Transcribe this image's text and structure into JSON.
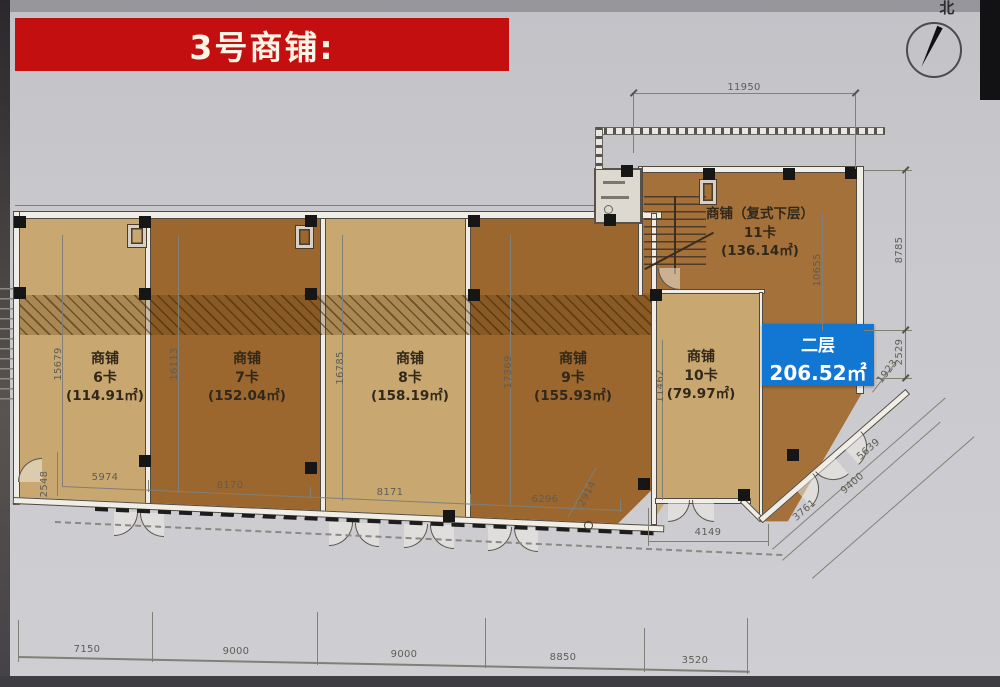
{
  "banner": {
    "title": "3号商铺:"
  },
  "compass": {
    "north_label": "北"
  },
  "floor_badge": {
    "floor": "二层",
    "area": "206.52㎡",
    "bg_color": "#1277d3"
  },
  "shops": [
    {
      "title": "商铺",
      "unit": "6卡",
      "area": "(114.91㎡)",
      "height_dim": "15679",
      "tone": "light"
    },
    {
      "title": "商铺",
      "unit": "7卡",
      "area": "(152.04㎡)",
      "height_dim": "16113",
      "tone": "brown"
    },
    {
      "title": "商铺",
      "unit": "8卡",
      "area": "(158.19㎡)",
      "height_dim": "16785",
      "tone": "light"
    },
    {
      "title": "商铺",
      "unit": "9卡",
      "area": "(155.93㎡)",
      "height_dim": "17369",
      "tone": "brown"
    },
    {
      "title": "商铺",
      "unit": "10卡",
      "area": "(79.97㎡)",
      "height_dim": "11462",
      "tone": "light"
    },
    {
      "title": "商铺（复式下层）",
      "unit": "11卡",
      "area": "(136.14㎡)",
      "tone": "brown"
    }
  ],
  "dims": {
    "top_width": "11950",
    "heights": [
      "15679",
      "16113",
      "16785",
      "17369",
      "11462"
    ],
    "right_height_upper": "8785",
    "right_height_lower": "2529",
    "right_inner_height": "10655",
    "right_diag_small": "1923",
    "inner_left_small": "2548",
    "inner_widths": [
      "5974",
      "8170",
      "8171",
      "6296"
    ],
    "inner_diag_small": "2914",
    "inner_width_right": "4149",
    "diag_widths": [
      "3761",
      "9400",
      "5639"
    ],
    "bottom_widths": [
      "7150",
      "9000",
      "9000",
      "8850",
      "3520"
    ]
  },
  "plan_colors": {
    "light_shop": "#c8a770",
    "brown_shop": "#9c672e",
    "upper_shop": "#a4713a"
  }
}
